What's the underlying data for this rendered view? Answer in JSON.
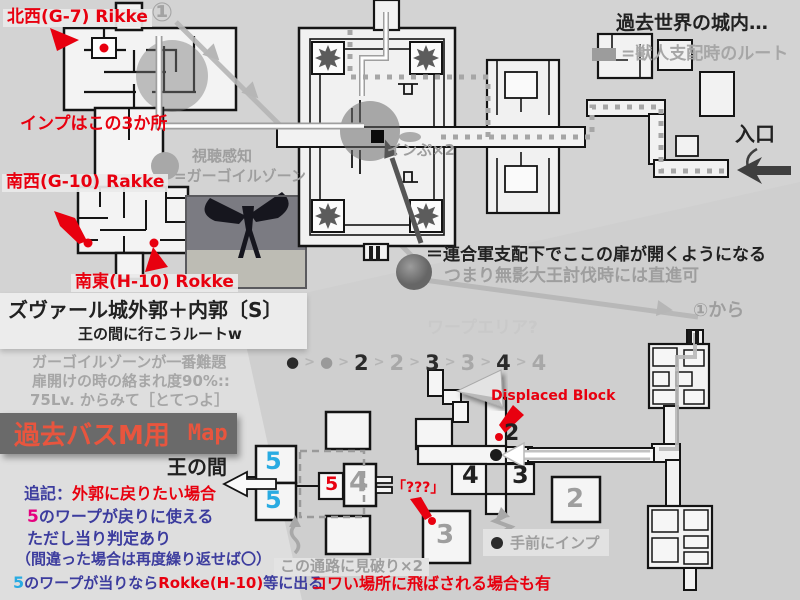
{
  "colors": {
    "red": "#e8000f",
    "navy": "#3c3c9e",
    "magenta": "#e5007e",
    "cyan": "#29abe2",
    "gray_text": "#9e9e9e",
    "banner_text": "#e8553e",
    "route_gray": "#b6b6b6",
    "background": "#d3d3d3"
  },
  "header": {
    "circled_one": "①",
    "world_note": "過去世界の城内…",
    "beast_route": "=獣人支配時のルート"
  },
  "entrance": {
    "label": "入口"
  },
  "imps": {
    "nw": "北西(G-7) Rikke",
    "spots": "インプはこの3か所",
    "sw": "南西(G-10) Rakke",
    "se": "南東(H-10) Rokke",
    "x2": "インぷ×2"
  },
  "gargoyle": {
    "sense": "視聴感知",
    "zone": "=ガーゴイルゾーン"
  },
  "door_note": {
    "line1": "＝連合軍支配下でここの扉が開くようになる",
    "line2": "つまり無影大王討伐時には直進可"
  },
  "from_one": {
    "label": "①から"
  },
  "title_block": {
    "title": "ズヴァール城外郭＋内郭〔S〕",
    "subtitle": "王の間に行こうルートw",
    "note1": "ガーゴイルゾーンが一番難題",
    "note2": "扉開けの時の絡まれ度90%::",
    "note3": "75Lv. からみて［とてつよ］"
  },
  "banner": {
    "title": "過去バスM用",
    "map": "Map"
  },
  "throne": {
    "label": "王の間"
  },
  "warp": {
    "faint": "ワープエリア?",
    "sequence": [
      "●",
      ">",
      "●",
      ">",
      "2",
      ">",
      "2",
      ">",
      "3",
      ">",
      "3",
      ">",
      "4",
      ">",
      "4"
    ],
    "displaced": "Displaced Block",
    "mystery": "「???」",
    "imp_near": "手前にインプ",
    "lookout": "この通路に見破り×2",
    "scary": "コワい場所に飛ばされる場合も有"
  },
  "notes": {
    "l1_prefix": "追記：",
    "l1_red": "外郭に戻りたい場合",
    "l2_num": "5",
    "l2_rest": "のワープが戻りに使える",
    "l3": "ただし当り判定あり",
    "l4": "（間違った場合は再度繰り返せば〇）",
    "l5_num": "5",
    "l5_mid": "のワープが当りなら",
    "l5_red": "Rokke(H-10)",
    "l5_end": "等に出る"
  },
  "rooms": {
    "two": "2",
    "three": "3",
    "four": "4",
    "five": "5"
  }
}
